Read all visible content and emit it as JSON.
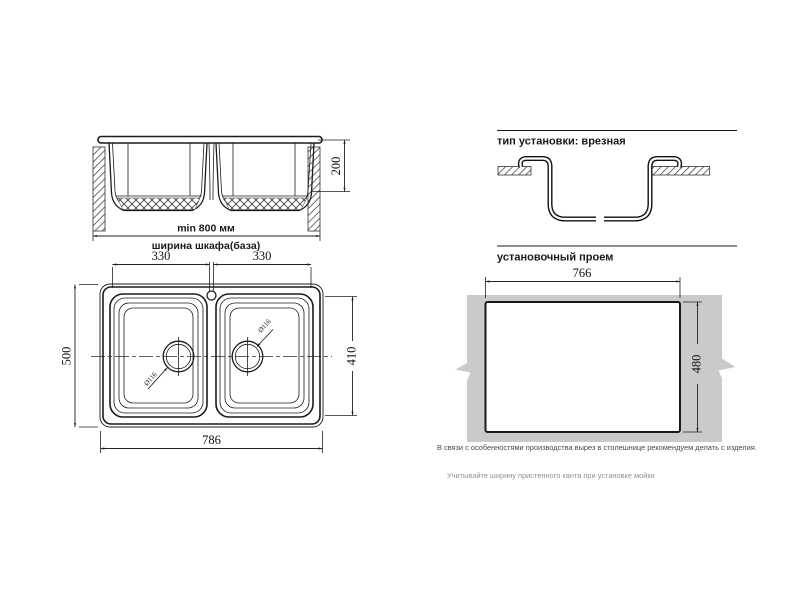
{
  "front_view": {
    "depth": "200",
    "min_width": "min 800 мм",
    "cabinet_label": "ширина шкафа(база)"
  },
  "top_view": {
    "left_bowl_width": "330",
    "right_bowl_width": "330",
    "overall_depth": "500",
    "bowls_depth": "410",
    "overall_width": "786",
    "left_drain_diameter": "Ø116",
    "right_drain_diameter": "Ø116"
  },
  "install_type": {
    "title": "тип установки: врезная"
  },
  "opening": {
    "title": "установочный проем",
    "width": "766",
    "depth": "480",
    "note_cutout": "В связи с особенностями производства вырез в столешнице рекомендуем делать с изделия.",
    "note_edge": "Учитывайте ширину пристенного канта при установке мойки"
  },
  "colors": {
    "line": "#1c1c1c",
    "countertop_panel": "#c9cacb",
    "note_light": "#909090"
  }
}
